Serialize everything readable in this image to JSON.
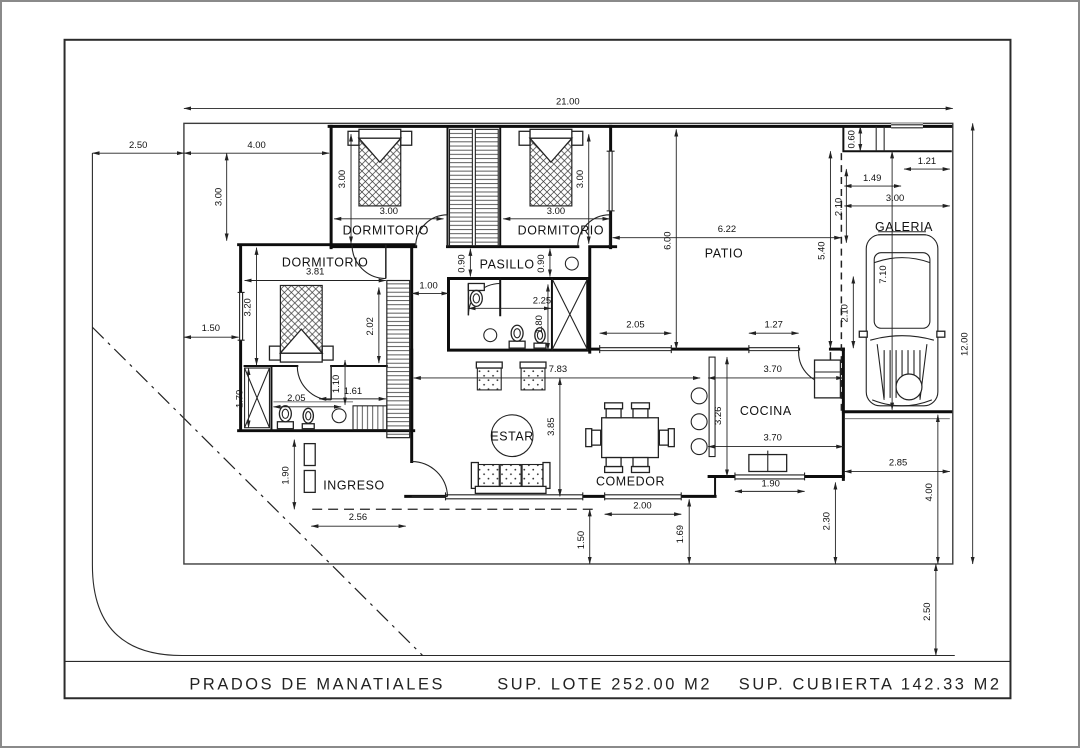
{
  "title_block": {
    "project": "PRADOS DE MANATIALES",
    "sup_lote": "SUP. LOTE 252.00 M2",
    "sup_cubierta": "SUP. CUBIERTA 142.33 M2"
  },
  "rooms": {
    "dormitorio_a": "DORMITORIO",
    "dormitorio_b": "DORMITORIO",
    "dormitorio_c": "DORMITORIO",
    "pasillo": "PASILLO",
    "patio": "PATIO",
    "galeria": "GALERIA",
    "cocina": "COCINA",
    "estar": "ESTAR",
    "comedor": "COMEDOR",
    "ingreso": "INGRESO"
  },
  "dimensions": {
    "lot_width": "21.00",
    "lot_depth": "12.00",
    "sidewalk": "2.50",
    "front_yard_width": "4.00",
    "front_yard_depth": "3.00",
    "dorm_a_width": "3.00",
    "dorm_a_height": "3.00",
    "dorm_b_width": "3.00",
    "dorm_b_height": "3.00",
    "patio_width": "6.22",
    "patio_height": "6.00",
    "patio_window_a": "2.05",
    "patio_window_b": "1.27",
    "galeria_shelf": "0.60",
    "galeria_top_a": "1.21",
    "galeria_top_b": "1.49",
    "galeria_width": "3.00",
    "galeria_offset": "2.10",
    "galeria_depth": "5.40",
    "car_length": "7.10",
    "car_width": "2.10",
    "dorm_c_width": "3.81",
    "dorm_c_height": "3.20",
    "dorm_c_bed": "2.02",
    "side_setback": "1.50",
    "bath_c_width": "2.05",
    "bath_c_closet": "1.70",
    "bath_c_door": "1.10",
    "bath_c_inner": "1.61",
    "hall_door_a": "0.90",
    "hall_door_b": "0.90",
    "passage_width": "1.00",
    "bath_width": "2.25",
    "bath_height": "1.80",
    "estar_width": "7.83",
    "estar_height": "3.85",
    "cocina_width": "3.70",
    "cocina_height": "3.26",
    "cocina_width_b": "3.70",
    "cocina_window": "1.90",
    "backyard_width": "2.85",
    "backyard_depth": "4.00",
    "backyard_step": "2.30",
    "street_offset": "2.50",
    "ingreso_depth": "1.90",
    "ingreso_width": "2.56",
    "comedor_window": "2.00",
    "setback_a": "1.50",
    "setback_b": "1.69"
  }
}
